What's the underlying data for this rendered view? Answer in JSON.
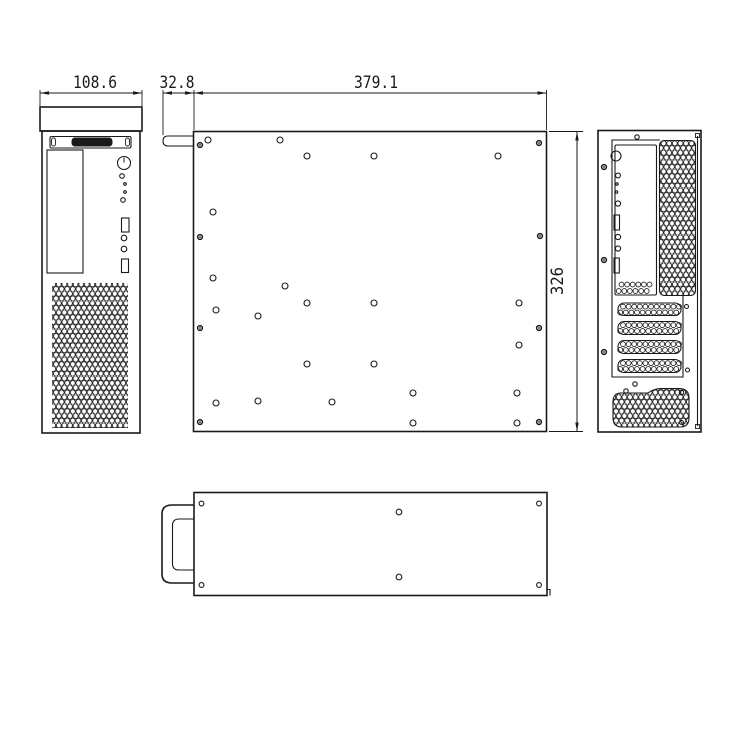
{
  "colors": {
    "ink": "#1a1a1a",
    "paper": "#ffffff"
  },
  "canvas": {
    "width": 750,
    "height": 750
  },
  "logo_text": "DIVAR",
  "dimensions": [
    {
      "label": "108.6",
      "type": "h",
      "x1": 40,
      "x2": 142,
      "y": 93,
      "tx": 95,
      "ty": 88,
      "tl": 44,
      "ext": [
        [
          40,
          90,
          40,
          106
        ],
        [
          142,
          90,
          142,
          106
        ]
      ]
    },
    {
      "label": "32.8",
      "type": "h",
      "x1": 163,
      "x2": 194,
      "y": 93,
      "tx": 177,
      "ty": 88,
      "tl": 35,
      "ext": [
        [
          163,
          90,
          163,
          135
        ]
      ]
    },
    {
      "label": "379.1",
      "type": "h",
      "x1": 194,
      "x2": 546.5,
      "y": 93,
      "tx": 376,
      "ty": 88,
      "tl": 44,
      "ext": [
        [
          194,
          90,
          194,
          130
        ],
        [
          546.5,
          90,
          546.5,
          130
        ]
      ]
    },
    {
      "label": "326",
      "type": "v",
      "x": 577,
      "y1": 131.5,
      "y2": 431.5,
      "tx": 563,
      "ty": 281,
      "tl": 28,
      "ext": [
        [
          549,
          131.5,
          583,
          131.5
        ],
        [
          549,
          431.5,
          583,
          431.5
        ]
      ]
    }
  ],
  "front_view": {
    "cap": [
      40,
      107,
      102,
      24
    ],
    "body": [
      42,
      131,
      98,
      302
    ],
    "logo_strip": [
      50,
      136.5,
      81,
      11.5
    ],
    "logo_brackets": [
      [
        51.5,
        138,
        4,
        8
      ],
      [
        125.5,
        138,
        4,
        8
      ]
    ],
    "logo_badge": [
      71.5,
      137.5,
      41,
      9
    ],
    "drive_bay": [
      47,
      150,
      36,
      123
    ],
    "power_button": [
      124,
      163,
      6.5
    ],
    "leds": [
      [
        122,
        176,
        2.3
      ],
      [
        125,
        184,
        1.3
      ],
      [
        125,
        192,
        1.3
      ],
      [
        123,
        200,
        2.3
      ],
      [
        124,
        238,
        2.8
      ],
      [
        124,
        249,
        2.8
      ]
    ],
    "usb_ports": [
      [
        121.5,
        218,
        7.5,
        14
      ],
      [
        121.5,
        259,
        7,
        13.5
      ]
    ],
    "grille": [
      52,
      283,
      76,
      145
    ]
  },
  "side_view": {
    "panel": [
      193.5,
      131.5,
      353,
      300
    ],
    "handle_tab": [
      163,
      136,
      30.5,
      10
    ],
    "hole_r": 3,
    "holes": [
      [
        208,
        140
      ],
      [
        280,
        140
      ],
      [
        307,
        156
      ],
      [
        374,
        156
      ],
      [
        498,
        156
      ],
      [
        213,
        212
      ],
      [
        213,
        278
      ],
      [
        285,
        286
      ],
      [
        307,
        303
      ],
      [
        374,
        303
      ],
      [
        519,
        303
      ],
      [
        216,
        310
      ],
      [
        258,
        316
      ],
      [
        519,
        345
      ],
      [
        307,
        364
      ],
      [
        374,
        364
      ],
      [
        413,
        393
      ],
      [
        517,
        393
      ],
      [
        258,
        401
      ],
      [
        216,
        403
      ],
      [
        332,
        402
      ],
      [
        413,
        423
      ],
      [
        517,
        423
      ]
    ],
    "rivets": [
      [
        200,
        145
      ],
      [
        539,
        143
      ],
      [
        200,
        237
      ],
      [
        540,
        236
      ],
      [
        200,
        328
      ],
      [
        539,
        328
      ],
      [
        200,
        422
      ],
      [
        539,
        422
      ]
    ]
  },
  "rear_view": {
    "panel": [
      598,
      130.5,
      103,
      301.5
    ],
    "inner_wall": [
      697.5,
      136,
      697.5,
      426
    ],
    "wall_ticks": [
      [
        695.5,
        133.5,
        4,
        4
      ],
      [
        695.5,
        424.5,
        4,
        4
      ]
    ],
    "inner_frame_path": "M660,140 H612 V377 H683 V296",
    "io_panel": [
      615,
      145,
      41.5,
      150
    ],
    "io_circles": [
      [
        616,
        156,
        5
      ],
      [
        618,
        175.5,
        2.4
      ],
      [
        617,
        184,
        1.2
      ],
      [
        616.5,
        192,
        1.2
      ],
      [
        618,
        203.5,
        2.6
      ],
      [
        618,
        237,
        2.6
      ],
      [
        618,
        248.5,
        2.6
      ]
    ],
    "io_rects": [
      [
        614,
        215,
        5.5,
        15
      ],
      [
        614,
        258,
        5.3,
        15
      ]
    ],
    "io_vent": {
      "x": 621.5,
      "y": 284.5,
      "cols": 6,
      "rows": 2,
      "dx": 5.6,
      "dy": 6.5,
      "stagger": -2.8,
      "r": 2.4
    },
    "grille": [
      659.5,
      140.5,
      36,
      155
    ],
    "slots": [
      [
        618,
        303,
        63,
        12.5
      ],
      [
        618,
        321.5,
        63,
        13
      ],
      [
        618,
        340.5,
        63,
        13
      ],
      [
        618,
        359.5,
        63,
        13
      ]
    ],
    "slot_screws": [
      [
        686.5,
        306.5,
        2
      ],
      [
        687.5,
        370,
        2
      ]
    ],
    "screw_holes": [
      [
        637,
        137,
        2.2
      ],
      [
        635,
        384,
        2.2
      ]
    ],
    "rivets": [
      [
        604,
        167
      ],
      [
        604,
        260
      ],
      [
        604,
        352
      ]
    ],
    "psu_vent_path": "M621,393 H648 Q654,388.5 661,388.5 H679 Q689,388.5 689,398 V418 Q689,427 680,427 H622 Q613,427 613,418 V402 Q613,393 621,393 Z",
    "psu_screws": [
      [
        626,
        391,
        2.2
      ],
      [
        681.5,
        392.5,
        2.2
      ],
      [
        681.5,
        422.5,
        2
      ]
    ]
  },
  "bottom_view": {
    "panel": [
      194,
      492.5,
      353,
      103
    ],
    "handle_outer": "M194,505 H172 Q162,505 162,514 V574 Q162,583 172,583 H194",
    "handle_inner": "M194,519 H179 Q172.5,519 172.5,525.5 V563.5 Q172.5,570 179,570 H194",
    "corner_holes": [
      [
        201.5,
        503.5
      ],
      [
        539,
        503.5
      ],
      [
        201.5,
        585
      ],
      [
        539,
        585
      ]
    ],
    "center_holes": [
      [
        399,
        512
      ],
      [
        399,
        577
      ]
    ],
    "corner_step": "M547,589.5 h3 v6"
  }
}
